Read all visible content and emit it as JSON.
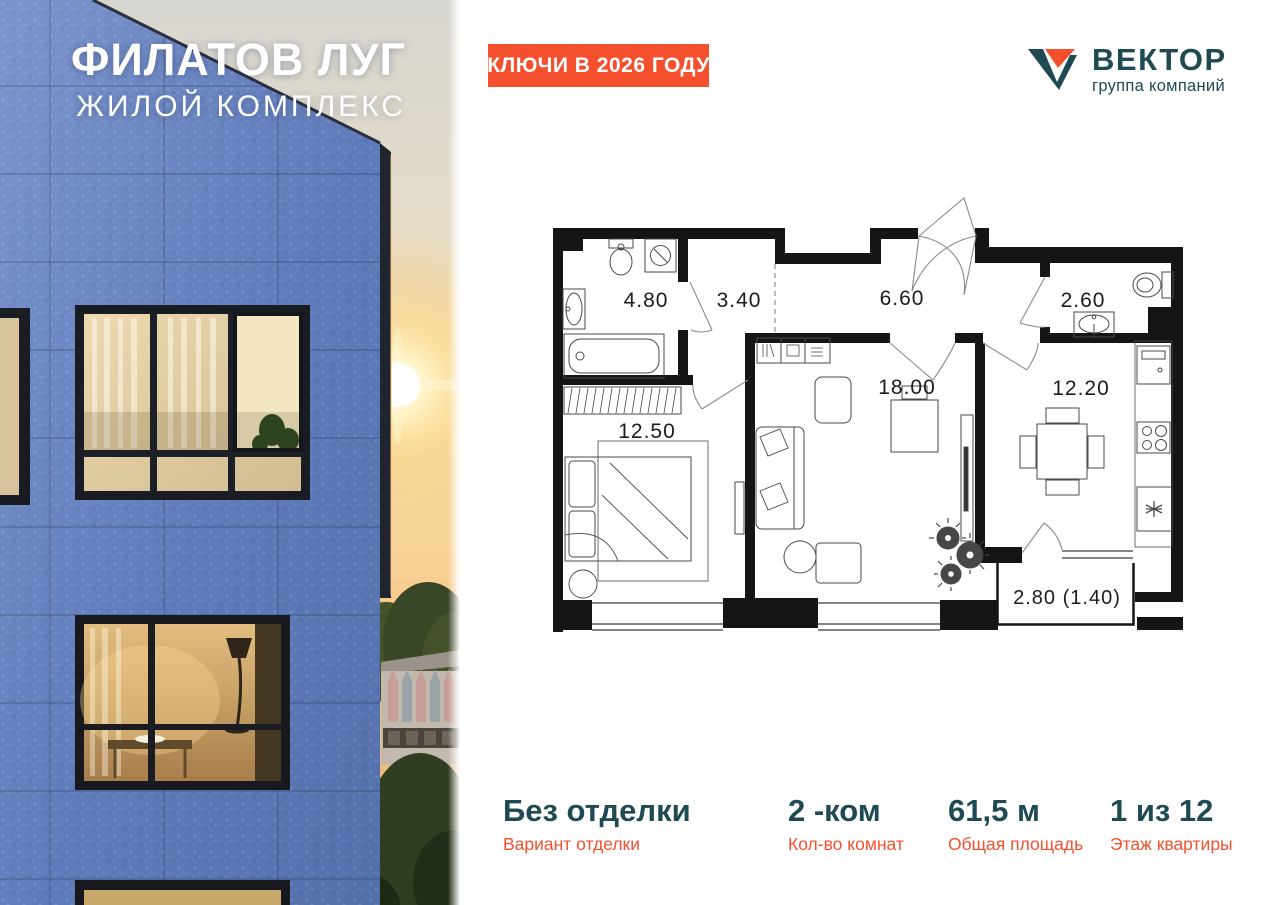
{
  "photo": {
    "title": "ФИЛАТОВ ЛУГ",
    "subtitle": "ЖИЛОЙ КОМПЛЕКС"
  },
  "header": {
    "badge_label": "КЛЮЧИ В 2026 ГОДУ",
    "logo_name": "ВЕКТОР",
    "logo_tagline": "группа компаний"
  },
  "floor_plan": {
    "rooms": [
      {
        "name": "bathroom",
        "area": "4.80"
      },
      {
        "name": "hallway",
        "area": "3.40"
      },
      {
        "name": "entrance-hall",
        "area": "6.60"
      },
      {
        "name": "wc",
        "area": "2.60"
      },
      {
        "name": "bedroom",
        "area": "12.50"
      },
      {
        "name": "living-room",
        "area": "18.00"
      },
      {
        "name": "kitchen",
        "area": "12.20"
      },
      {
        "name": "balcony",
        "area": "2.80 (1.40)"
      }
    ]
  },
  "details": [
    {
      "value": "Без отделки",
      "label": "Вариант отделки"
    },
    {
      "value": "2 -ком",
      "label": "Кол-во комнат"
    },
    {
      "value": "61,5 м",
      "label": "Общая площадь"
    },
    {
      "value": "1 из 12",
      "label": "Этаж квартиры"
    }
  ],
  "colors": {
    "accent_orange": "#F4502E",
    "brand_teal": "#1F4A54",
    "facade_blue": "#6080BD"
  }
}
